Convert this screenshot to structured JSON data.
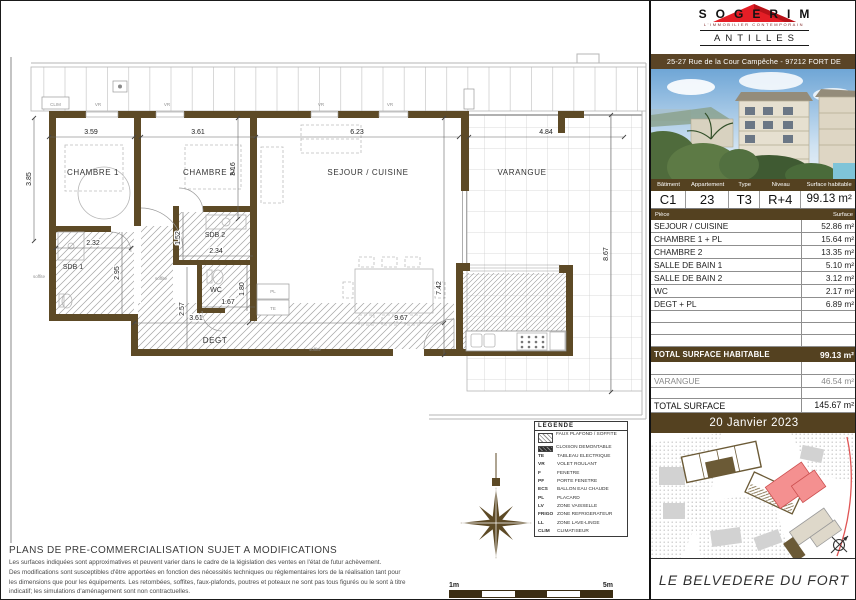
{
  "plan": {
    "labels": {
      "chambre1": "CHAMBRE 1",
      "chambre2": "CHAMBRE 2",
      "sejour": "SEJOUR / CUISINE",
      "varangue": "VARANGUE",
      "sdb1": "SDB 1",
      "sdb2": "SDB 2",
      "wc": "WC",
      "degt": "DEGT",
      "clim": "CLIM",
      "soffite": "soffite",
      "pl": "PL",
      "te": "TE",
      "vr": "VR"
    },
    "dims": {
      "chambre1_w": "3.59",
      "chambre2_w": "3.61",
      "sejour_w": "6.23",
      "varangue_w": "4.84",
      "chambre1_h": "3.85",
      "chambre2_h": "3.16",
      "sejour_h": "7.42",
      "varangue_h": "8.67",
      "sdb1_w": "2.32",
      "sdb1_h": "2.95",
      "sdb2_w": "2.34",
      "sdb2_h": "1.52",
      "wc_w": "1.67",
      "wc_h": "1.80",
      "degt_w": "3.61",
      "degt_h": "2.57",
      "total_w": "9.67"
    }
  },
  "legend": {
    "title": "LEGENDE",
    "items": [
      {
        "code": "",
        "label": "FAUX PLAFOND / SOFFITE"
      },
      {
        "code": "",
        "label": "CLOISON DEMONTABLE"
      },
      {
        "code": "TE",
        "label": "TABLEAU ELECTRIQUE"
      },
      {
        "code": "VR",
        "label": "VOLET ROULANT"
      },
      {
        "code": "F",
        "label": "FENETRE"
      },
      {
        "code": "PF",
        "label": "PORTE FENETRE"
      },
      {
        "code": "ECS",
        "label": "BALLON EAU CHAUDE"
      },
      {
        "code": "PL",
        "label": "PLACARD"
      },
      {
        "code": "LV",
        "label": "ZONE VAISSELLE"
      },
      {
        "code": "FRIGO",
        "label": "ZONE REFRIGERATEUR"
      },
      {
        "code": "LL",
        "label": "ZONE LAVE-LINGE"
      },
      {
        "code": "CLIM",
        "label": "CLIMATISEUR"
      }
    ]
  },
  "disclaimer": {
    "title": "PLANS DE PRE-COMMERCIALISATION SUJET A MODIFICATIONS",
    "lines": [
      "Les surfaces indiquées sont approximatives et peuvent varier dans le cadre de la législation des ventes en l'état de futur achèvement.",
      "Des modifications sont susceptibles d'être apportées en fonction des nécessités techniques ou réglementaires lors de la réalisation tant pour",
      "les dimensions que pour les équipements. Les retombées, soffites, faux-plafonds, poutres et poteaux ne sont pas tous figurés ou le sont à titre",
      "indicatif; les simulations d'aménagement sont non contractuelles."
    ]
  },
  "scalebar": {
    "min": "1m",
    "max": "5m"
  },
  "sidebar": {
    "brand": {
      "name": "SOGERIM",
      "tagline": "L'IMMOBILIER CONTEMPORAIN",
      "region": "ANTILLES"
    },
    "address": "25-27 Rue de la Cour Campêche - 97212 FORT DE FRANCE",
    "info": {
      "headers": [
        "Bâtiment",
        "Appartement",
        "Type",
        "Niveau",
        "Surface habitable"
      ],
      "values": [
        "C1",
        "23",
        "T3",
        "R+4",
        "99.13 m²"
      ]
    },
    "rooms": {
      "headers": [
        "Pièce",
        "Surface"
      ],
      "rows": [
        [
          "SEJOUR / CUISINE",
          "52.86 m²"
        ],
        [
          "CHAMBRE 1 + PL",
          "15.64 m²"
        ],
        [
          "CHAMBRE 2",
          "13.35 m²"
        ],
        [
          "SALLE DE BAIN 1",
          "5.10 m²"
        ],
        [
          "SALLE DE BAIN 2",
          "3.12 m²"
        ],
        [
          "WC",
          "2.17 m²"
        ],
        [
          "DEGT + PL",
          "6.89 m²"
        ]
      ]
    },
    "totals": {
      "habitable_label": "TOTAL SURFACE HABITABLE",
      "habitable_value": "99.13 m²",
      "varangue_label": "VARANGUE",
      "varangue_value": "46.54 m²",
      "total_label": "TOTAL SURFACE",
      "total_value": "145.67 m²"
    },
    "date": "20 Janvier 2023",
    "project": "LE BELVEDERE DU FORT"
  },
  "colors": {
    "brown": "#544120",
    "wall": "#5d4a26",
    "logo_red": "#e41e26",
    "map_highlight": "#f08e8e"
  }
}
